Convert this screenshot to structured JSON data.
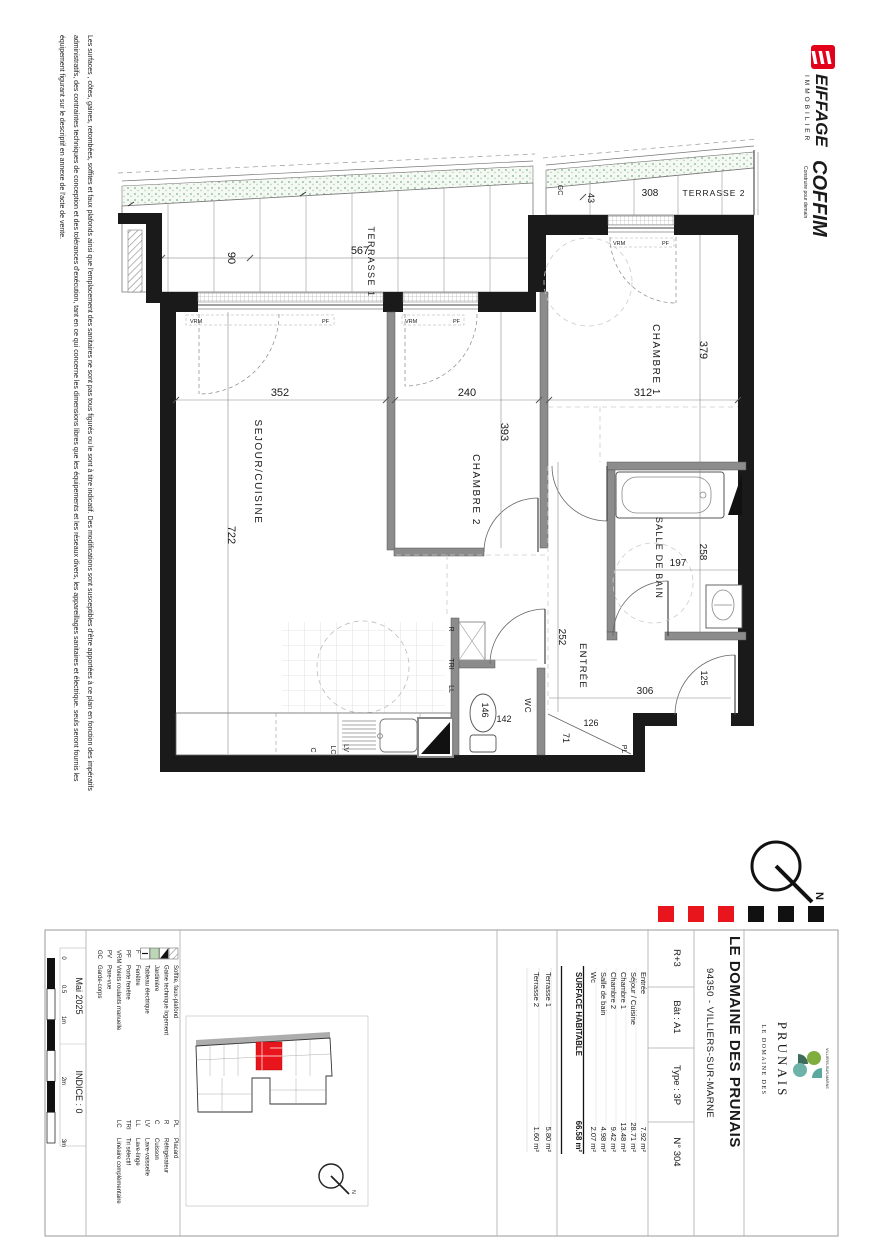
{
  "disclaimer": {
    "lines": [
      "Les surfaces , côtes, gaines, retombées, soffites et faux plafonds ainsi que l'emplacement des sanitaires ne sont pas tous figurés ou le sont à titre indicatif. Des modifications sont susceptibles d'être apportées à ce plan en fonction des impératifs",
      "administratifs, des contraintes techniques de conception et des tolérances d'exécution, tant en ce qui concerne les dimensions libres que les équipements et les réseaux divers, les appareillages sanitaires et électrique. seuls seront fournis les",
      "équipement figurant sur le descriptif en annexe de l'acte de vente."
    ]
  },
  "logos": {
    "eiffage": {
      "name": "EIFFAGE",
      "sub": "IMMOBILIER"
    },
    "coffim": {
      "name": "COFFIM",
      "tagline": "Construire pour demain"
    }
  },
  "plan": {
    "labels": {
      "sejour": "SEJOUR/CUISINE",
      "chambre2": "CHAMBRE 2",
      "chambre1": "CHAMBRE 1",
      "sdb": "SALLE DE BAIN",
      "entree": "ENTRÉE",
      "wc": "WC",
      "terrasse1": "TERRASSE 1",
      "terrasse2": "TERRASSE 2"
    },
    "dims": {
      "d352": "352",
      "d722": "722",
      "d240": "240",
      "d393": "393",
      "d312": "312",
      "d379": "379",
      "d197": "197",
      "d258": "258",
      "d567": "567",
      "d90": "90",
      "d308": "308",
      "d43": "43",
      "d252": "252",
      "d306": "306",
      "d125": "125",
      "d126": "126",
      "d71": "71",
      "d146": "146",
      "d142": "142"
    },
    "tags": {
      "gc": "GC",
      "pl": "PL",
      "r": "R",
      "tri": "TRI",
      "ll": "LL",
      "c": "C",
      "lc": "LC",
      "lv": "LV",
      "vrm": "VRM",
      "pf": "PF",
      "north": "N"
    }
  },
  "titleblock": {
    "project": "LE DOMAINE DES PRUNAIS",
    "address": "94350 - VILLIERS-SUR-MARNE",
    "info_cells": [
      "R+3",
      "Bât : A1",
      "Type : 3P",
      "N° 304"
    ],
    "surface_rows": [
      [
        "Entrée",
        "7.92 m²"
      ],
      [
        "Séjour / Cuisine",
        "28.71 m²"
      ],
      [
        "Chambre 1",
        "13.48 m²"
      ],
      [
        "Chambre 2",
        "9.42 m²"
      ],
      [
        "Salle de bain",
        "4.98 m²"
      ],
      [
        "Wc",
        "2.07 m²"
      ]
    ],
    "surface_total": [
      "SURFACE HABITABLE",
      "66.58 m²"
    ],
    "terrace_rows": [
      [
        "Terrasse 1",
        "5.80 m²"
      ],
      [
        "Terrasse 2",
        "1.60 m²"
      ]
    ],
    "legend_col1": [
      [
        "",
        "Soffite, faux-plafond"
      ],
      [
        "",
        "Gaine technique logement"
      ],
      [
        "",
        "Jardinière"
      ],
      [
        "",
        "Tableau électrique"
      ],
      [
        "F",
        "Fenêtre"
      ],
      [
        "PF",
        "Porte fenêtre"
      ],
      [
        "VRM",
        "Volets roulants manuelle"
      ],
      [
        "PV",
        "Pare-vue"
      ],
      [
        "GC",
        "Garde-corps"
      ]
    ],
    "legend_col2": [
      [
        "PL",
        "Placard"
      ],
      [
        "R",
        "Réfrigérateur"
      ],
      [
        "C",
        "Cuisson"
      ],
      [
        "LV",
        "Lave-vaisselle"
      ],
      [
        "LL",
        "Lave-linge"
      ],
      [
        "TRI",
        "Tri sélectif"
      ],
      [
        "LC",
        "Linéaire complémentaire"
      ]
    ],
    "date": "Mai 2025",
    "indice": "INDICE : 0",
    "scale_ticks": [
      "0",
      "0.5",
      "1m",
      "2m",
      "3m"
    ],
    "brand": {
      "top": "LE DOMAINE DES",
      "name": "PRUNAIS",
      "side": "VILLIERS-SUR-MARNE"
    }
  },
  "colors": {
    "wall": "#1a1a1a",
    "accent_red": "#e8151d",
    "eiffage_red": "#e2001a",
    "coffim_blue": "#24429e",
    "brand_green": "#6f7f55"
  }
}
